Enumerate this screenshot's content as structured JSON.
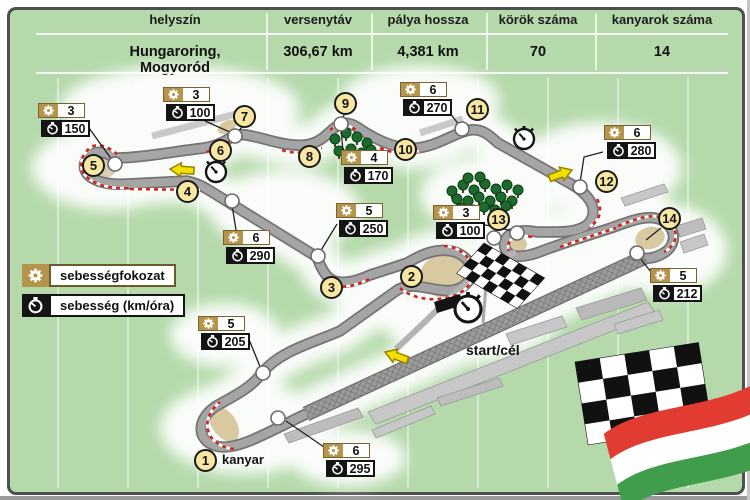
{
  "table": {
    "columns": [
      {
        "label": "helyszín",
        "value": "Hungaroring, Mogyoród"
      },
      {
        "label": "versenytáv",
        "value": "306,67 km"
      },
      {
        "label": "pálya hossza",
        "value": "4,381 km"
      },
      {
        "label": "körök száma",
        "value": "70"
      },
      {
        "label": "kanyarok száma",
        "value": "14"
      }
    ]
  },
  "legend": {
    "gear_label": "sebességfokozat",
    "speed_label": "sebesség (km/óra)"
  },
  "map": {
    "start_finish_label": "start/cél",
    "corner_word": "kanyar",
    "corners": [
      {
        "n": "1"
      },
      {
        "n": "2"
      },
      {
        "n": "3"
      },
      {
        "n": "4"
      },
      {
        "n": "5"
      },
      {
        "n": "6"
      },
      {
        "n": "7"
      },
      {
        "n": "8"
      },
      {
        "n": "9"
      },
      {
        "n": "10"
      },
      {
        "n": "11"
      },
      {
        "n": "12"
      },
      {
        "n": "13"
      },
      {
        "n": "14"
      }
    ],
    "speed_boxes": [
      {
        "gear": "3",
        "speed": "150"
      },
      {
        "gear": "3",
        "speed": "100"
      },
      {
        "gear": "6",
        "speed": "270"
      },
      {
        "gear": "4",
        "speed": "170"
      },
      {
        "gear": "5",
        "speed": "250"
      },
      {
        "gear": "6",
        "speed": "290"
      },
      {
        "gear": "6",
        "speed": "280"
      },
      {
        "gear": "3",
        "speed": "100"
      },
      {
        "gear": "5",
        "speed": "212"
      },
      {
        "gear": "5",
        "speed": "205"
      },
      {
        "gear": "6",
        "speed": "295"
      }
    ]
  },
  "colors": {
    "background_green": "#b5d9ab",
    "accent_tan": "#b5954c",
    "circle_yellow": "#f7e7a2",
    "curb_red": "#cc2823",
    "arrow_yellow": "#f3df00",
    "flag_red": "#e23b31",
    "flag_green": "#3f9d4b"
  }
}
